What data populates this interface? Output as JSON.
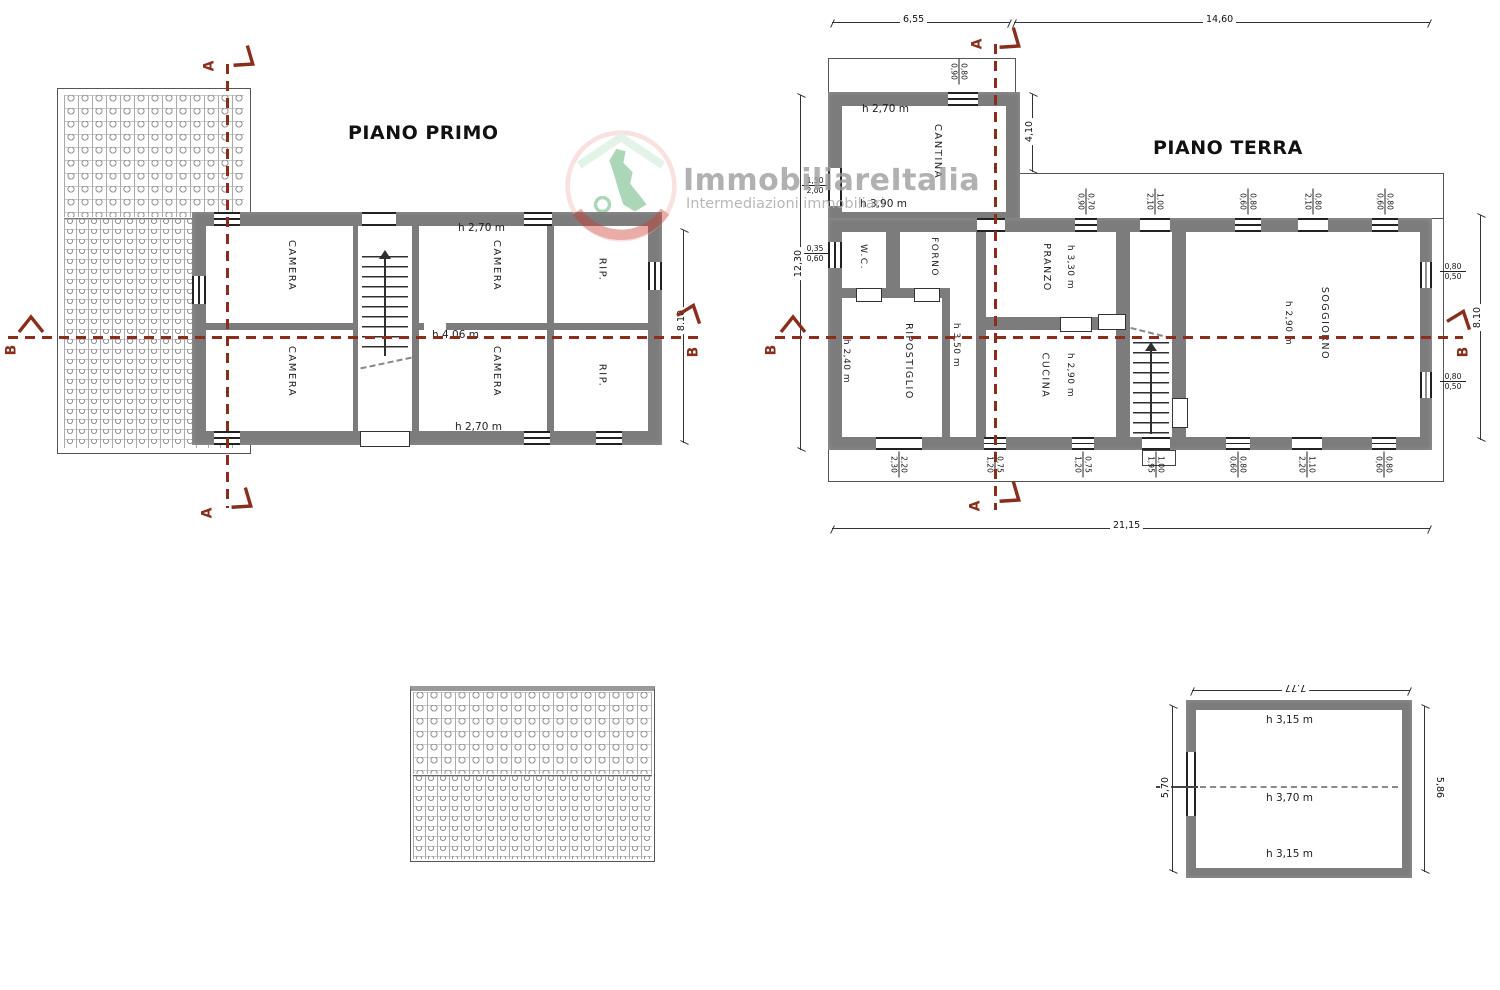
{
  "titles": {
    "piano_primo": "PIANO PRIMO",
    "piano_terra": "PIANO TERRA"
  },
  "watermark": {
    "brand": "ImmobiliareItalia",
    "tagline": "Intermediazioni immobiliari"
  },
  "sections": {
    "a": "A",
    "b": "B"
  },
  "colors": {
    "wall": "#7c7c7c",
    "section_red": "#8a2d1b",
    "watermark_gray": "#9e9e9e",
    "logo_green": "#3aa157",
    "logo_red": "#cf3b30"
  },
  "piano_primo": {
    "rooms": {
      "camera": "CAMERA",
      "rip": "RIP."
    },
    "heights": {
      "top": "h 2,70 m",
      "middle": "h 4,06 m",
      "bottom": "h 2,70 m"
    },
    "dims": {
      "right": "8.10"
    }
  },
  "piano_terra": {
    "rooms": {
      "cantina": {
        "label": "CANTINA",
        "h_top": "h 2,70 m",
        "h_bottom": "h 3,90 m"
      },
      "wc": {
        "label": "W.C."
      },
      "forno": {
        "label": "FORNO"
      },
      "pranzo": {
        "label": "PRANZO",
        "h": "h 3,30 m"
      },
      "ripostiglio": {
        "label": "RIPOSTIGLIO",
        "h": "h 2,40 m"
      },
      "corridoio": {
        "h": "h 3,50 m"
      },
      "cucina": {
        "label": "CUCINA",
        "h": "h 2,90 m"
      },
      "soggiorno": {
        "label": "SOGGIORNO",
        "h": "h 2,90 m"
      }
    },
    "dims": {
      "top_left": "6,55",
      "top_right": "14,60",
      "left": "12,30",
      "right": "8.10",
      "bottom": "21,15",
      "cantina_side": "4,10"
    },
    "opening_dims": {
      "cantina_top": {
        "w": "0,80",
        "h": "0,90"
      },
      "cantina_left": {
        "w": "1,50",
        "h": "2,00"
      },
      "wc_left": {
        "w": "0,35",
        "h": "0,60"
      },
      "top_1": {
        "w": "0,70",
        "h": "0,90"
      },
      "top_2": {
        "w": "1,00",
        "h": "2,10"
      },
      "top_3": {
        "w": "0,80",
        "h": "0,60"
      },
      "top_4": {
        "w": "0,80",
        "h": "2,10"
      },
      "top_5": {
        "w": "0,80",
        "h": "0,60"
      },
      "right_1": {
        "w": "0,80",
        "h": "0,50"
      },
      "right_2": {
        "w": "0,80",
        "h": "0,50"
      },
      "bottom_1": {
        "w": "2,20",
        "h": "2,30"
      },
      "bottom_2": {
        "w": "0,75",
        "h": "1,20"
      },
      "bottom_3": {
        "w": "0,75",
        "h": "1,20"
      },
      "bottom_4": {
        "w": "1,00",
        "h": "1,95"
      },
      "bottom_5": {
        "w": "0,80",
        "h": "0,60"
      },
      "bottom_6": {
        "w": "1,10",
        "h": "2,20"
      },
      "bottom_7": {
        "w": "0,80",
        "h": "0,60"
      }
    }
  },
  "attic": {
    "dims": {
      "top": "7.77",
      "left": "5,70",
      "right": "5,86"
    },
    "heights": {
      "top": "h 3,15 m",
      "middle": "h 3,70 m",
      "bottom": "h 3,15 m"
    }
  }
}
